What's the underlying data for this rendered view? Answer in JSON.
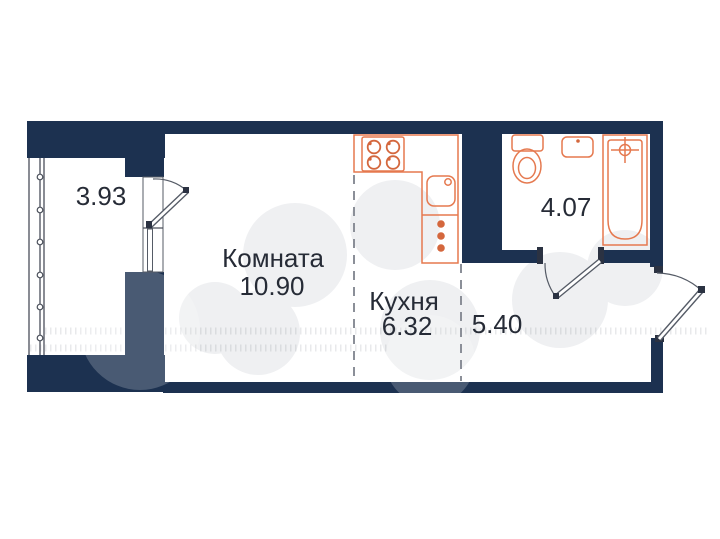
{
  "title": "Studio apartment floor plan",
  "colors": {
    "wall": "#1c3150",
    "fixture": "#e5794f",
    "accent": "#d4673d",
    "text": "#262b36",
    "dash": "#8b8f98",
    "frame": "#555b66",
    "watermark": "#eff0f2"
  },
  "rooms": {
    "living": {
      "name": "Комната",
      "area": "10.90"
    },
    "kitchen": {
      "name": "Кухня",
      "area": "6.32"
    },
    "hallway": {
      "area": "5.40"
    },
    "bathroom": {
      "area": "4.07"
    },
    "balcony": {
      "area": "3.93"
    }
  },
  "fixtures": {
    "kitchen": [
      "stove-icon",
      "kitchen-sink-icon",
      "cabinet-icon"
    ],
    "bathroom": [
      "toilet-icon",
      "washbasin-icon",
      "bathtub-icon"
    ],
    "doors": [
      "balcony-door",
      "bathroom-door",
      "entrance-door"
    ],
    "windows": [
      "balcony-glazing",
      "balcony-window"
    ]
  }
}
